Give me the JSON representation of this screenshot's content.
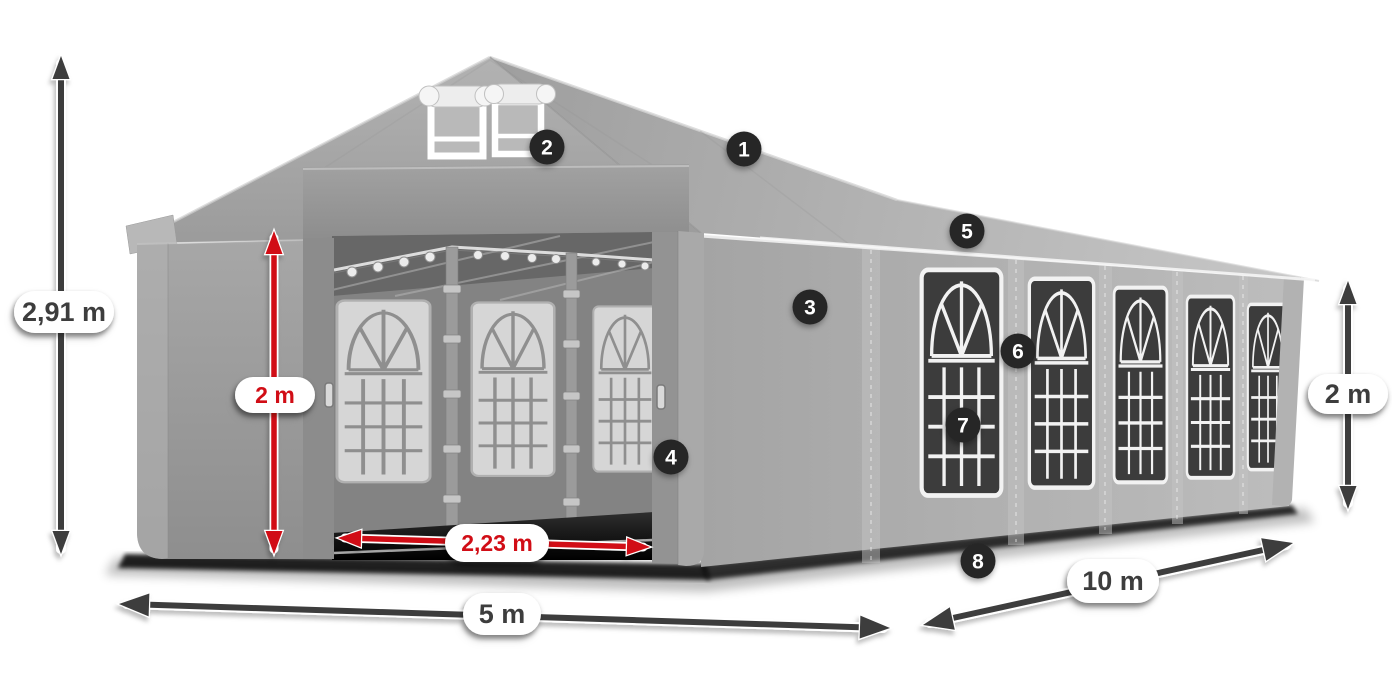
{
  "dimensions": {
    "total_height": {
      "label": "2,91 m",
      "style": "dark"
    },
    "door_height": {
      "label": "2 m",
      "style": "red"
    },
    "door_width": {
      "label": "2,23 m",
      "style": "red"
    },
    "front_width": {
      "label": "5 m",
      "style": "dark"
    },
    "side_length": {
      "label": "10 m",
      "style": "dark"
    },
    "wall_height": {
      "label": "2 m",
      "style": "dark"
    }
  },
  "hotspots": [
    {
      "number": "1"
    },
    {
      "number": "2"
    },
    {
      "number": "3"
    },
    {
      "number": "4"
    },
    {
      "number": "5"
    },
    {
      "number": "6"
    },
    {
      "number": "7"
    },
    {
      "number": "8"
    }
  ],
  "icons": {
    "dimension_arrow": "double-headed-arrow",
    "hotspot_badge": "numbered-circle"
  },
  "colors": {
    "dimension_dark": "#3e3e3e",
    "dimension_red": "#d10f14",
    "label_background": "#ffffff",
    "badge_background": "#262626",
    "badge_number": "#ffffff",
    "tent_gray": "#a6a6a6",
    "window_dark": "#3c3c3c",
    "window_grid": "#f2f2f2",
    "background": "#ffffff"
  }
}
